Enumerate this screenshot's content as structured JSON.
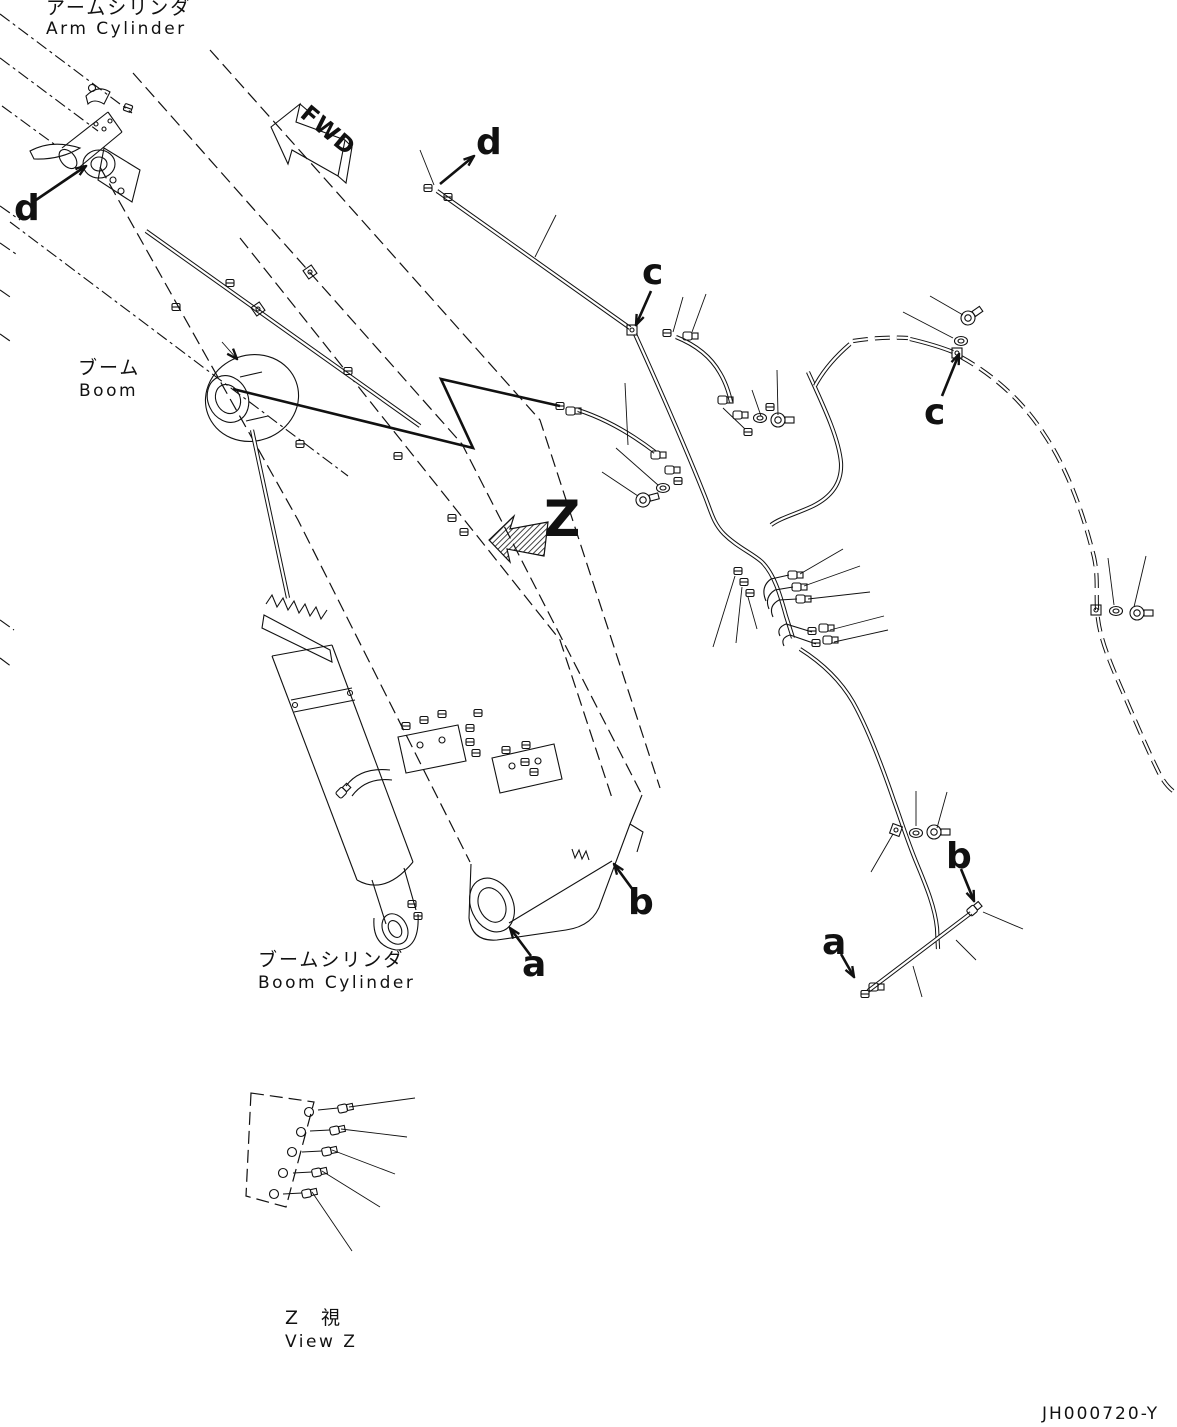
{
  "labels": {
    "arm_cylinder_jp": "アームシリンダ",
    "arm_cylinder_en": "Arm Cylinder",
    "boom_jp": "ブーム",
    "boom_en": "Boom",
    "boom_cylinder_jp": "ブームシリンダ",
    "boom_cylinder_en": "Boom Cylinder",
    "view_z_jp": "Z　視",
    "view_z_en": "View Z",
    "fwd_marker": "FWD",
    "doc_number": "JH000720-Y"
  },
  "callouts": {
    "d_arm_cylinder": "d",
    "d_tube_end": "d",
    "c_tube_clamp": "c",
    "c_hose_clamp": "c",
    "z_view_arrow": "Z",
    "b_boom_foot": "b",
    "a_boom_foot": "a",
    "b_pipe_right": "b",
    "a_pipe_right": "a"
  },
  "colors": {
    "line": "#111111",
    "background": "#ffffff"
  }
}
